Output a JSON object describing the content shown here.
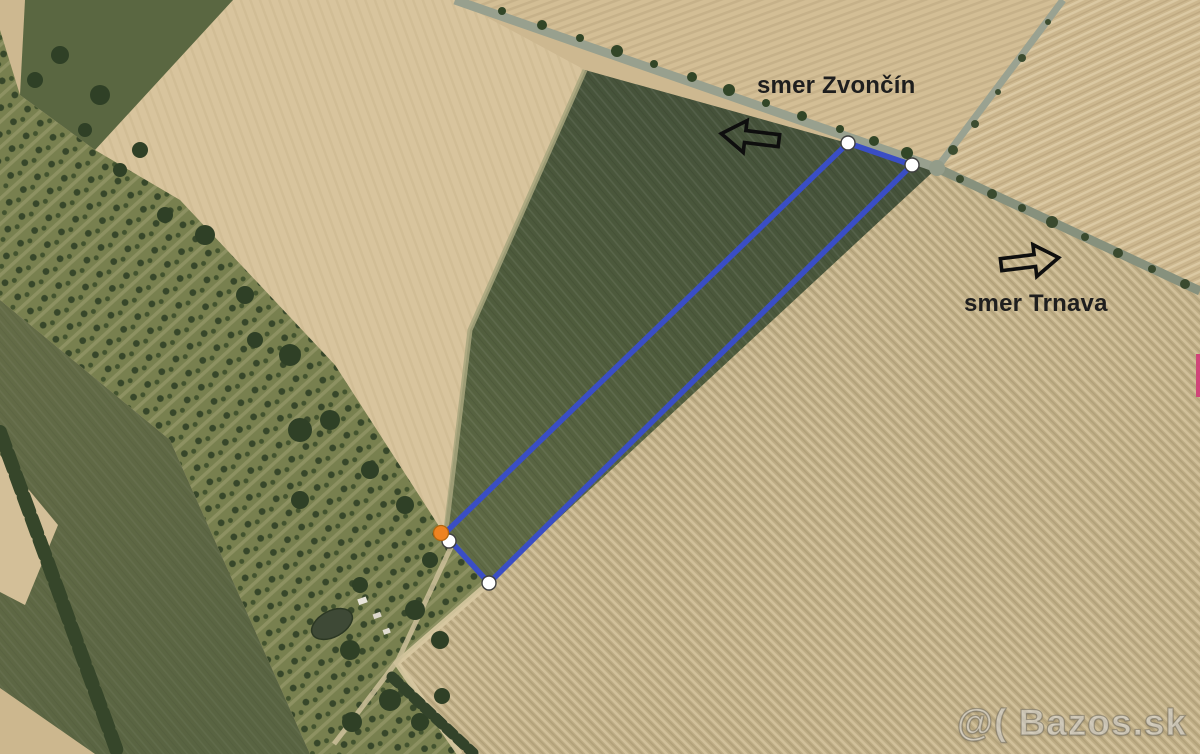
{
  "annotations": {
    "direction_labels": [
      {
        "id": "zvoncin",
        "text": "smer Zvončín",
        "arrow": "left"
      },
      {
        "id": "trnava",
        "text": "smer Trnava",
        "arrow": "right"
      }
    ],
    "watermark": "@( Bazos.sk"
  },
  "colors": {
    "polygon_blue": "#3a4ec5",
    "vertex_white": "#ffffff",
    "vertex_stroke": "#3f3f3f",
    "vertex_orange": "#ee8321",
    "orange_stroke": "#b0650f",
    "arrow_black": "#0e0e0e",
    "label_text": "#1e1e1e",
    "magenta_marker": "#d04579"
  },
  "map": {
    "type": "satellite-photo",
    "plot_outline": {
      "points": [
        [
          848,
          143
        ],
        [
          912,
          165
        ],
        [
          489,
          583
        ],
        [
          444,
          534
        ]
      ],
      "stroke_width": 5.5
    },
    "markers": {
      "white_vertices": [
        [
          848,
          143
        ],
        [
          912,
          165
        ],
        [
          489,
          583
        ],
        [
          449,
          541
        ]
      ],
      "white_radius": 7,
      "orange_vertex": [
        441,
        533
      ],
      "orange_radius": 7.5
    }
  }
}
